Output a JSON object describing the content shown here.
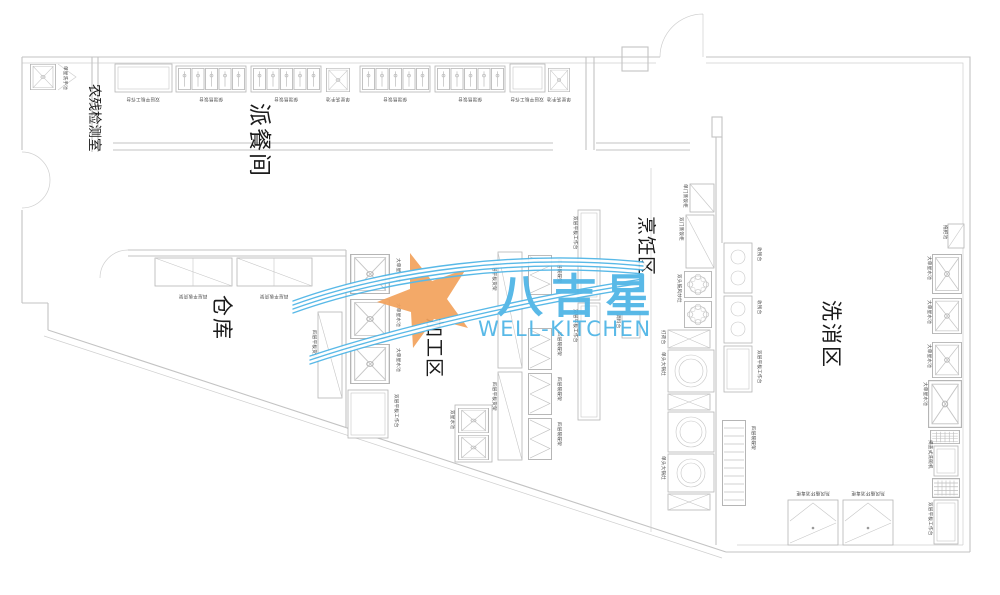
{
  "rooms": {
    "pesticide_test_room": "农残检测室",
    "serving_room": "派餐间",
    "warehouse": "仓库",
    "processing_area": "加工区",
    "cooking_area": "烹饪区",
    "washing_area": "洗消区"
  },
  "logo": {
    "name_cn": "八吉星",
    "name_en": "WELL-KITCHEN",
    "blue": "#4cb4e6",
    "orange": "#f3a25c"
  },
  "labels": {
    "worktable": "双层平板工作台",
    "servecounter": "保温售饭台",
    "handsink": "单星洗手池",
    "bigsink": "大单星水池",
    "doublesink": "双星水池",
    "rack": "四层平板货架",
    "bowlrack": "四层碗碟架",
    "steam_single": "单门蒸饭柜",
    "steam_double": "双门蒸饭柜",
    "wok": "双头鼓风炒灶",
    "bigpot": "单头大锅灶",
    "preptable": "打荷台",
    "spicecart": "调料台",
    "residue": "收残台",
    "dishwasher": "揭盖式洗碗机",
    "disinfect": "热风循环消毒柜",
    "mop": "拖把池"
  },
  "colors": {
    "wall_line": "#c3c3c3",
    "equipment_line": "#b5b5b5",
    "label_text": "#4a4a4a",
    "room_text": "#1b1b1b"
  }
}
